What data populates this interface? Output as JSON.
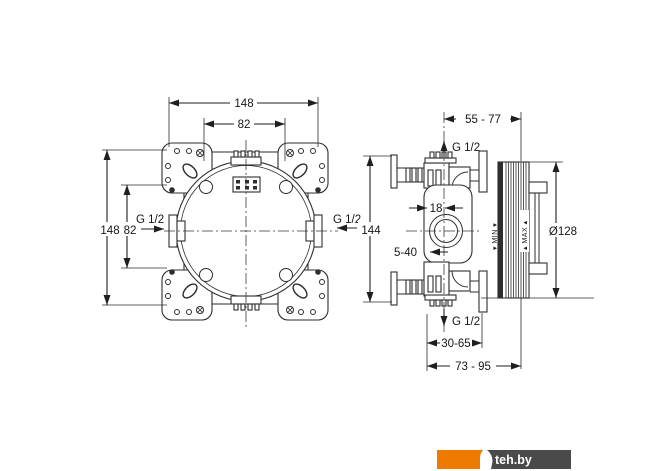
{
  "drawing": {
    "type": "installation-dimension-drawing",
    "front_view": {
      "dim_top_outer": "148",
      "dim_top_inner": "82",
      "dim_left_outer": "148",
      "dim_left_inner": "82",
      "thread_left": "G 1/2",
      "thread_right": "G 1/2"
    },
    "side_view": {
      "dim_depth_top": "55 - 77",
      "thread_top": "G 1/2",
      "thread_bottom": "G 1/2",
      "dim_body_height": "144",
      "dim_cartridge": "18",
      "dim_plaster_depth": "5-40",
      "dim_diameter": "Ø128",
      "label_min": "▾ MIN ▾",
      "label_max": "▴ MAX ▴",
      "dim_depth_mid": "30-65",
      "dim_depth_bottom": "73 - 95"
    },
    "line_color": "#2e2e2e"
  },
  "watermark": {
    "text": "teh.by",
    "orange_color": "#ef7a00",
    "gray_color": "#4a4a4a",
    "text_color": "#ffffff"
  }
}
